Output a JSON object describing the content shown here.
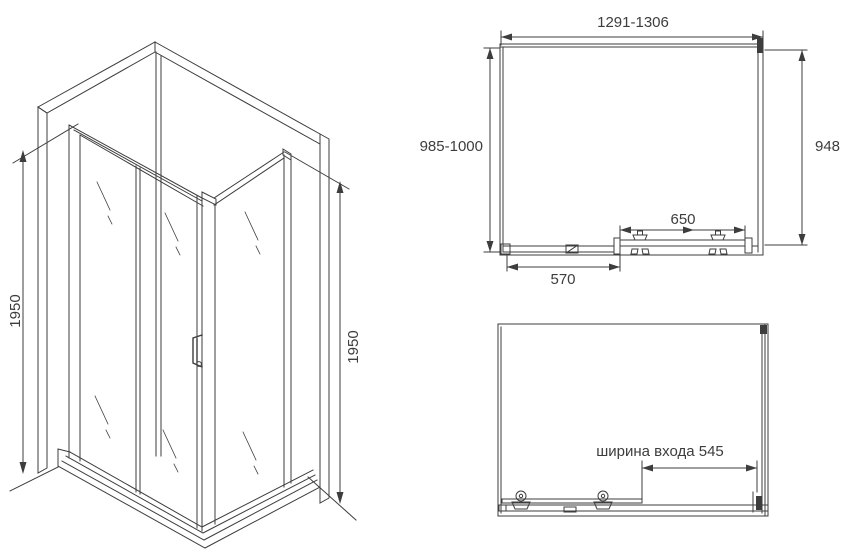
{
  "colors": {
    "ink": "#3d3d3d",
    "background": "#ffffff"
  },
  "isometric_view": {
    "height_left_label": "1950",
    "height_right_label": "1950"
  },
  "plan_view": {
    "width_label": "1291-1306",
    "depth_label": "985-1000",
    "right_depth_label": "948",
    "door_width_label": "650",
    "fixed_panel_width_label": "570"
  },
  "front_view": {
    "entrance_width_label": "ширина входа 545"
  }
}
